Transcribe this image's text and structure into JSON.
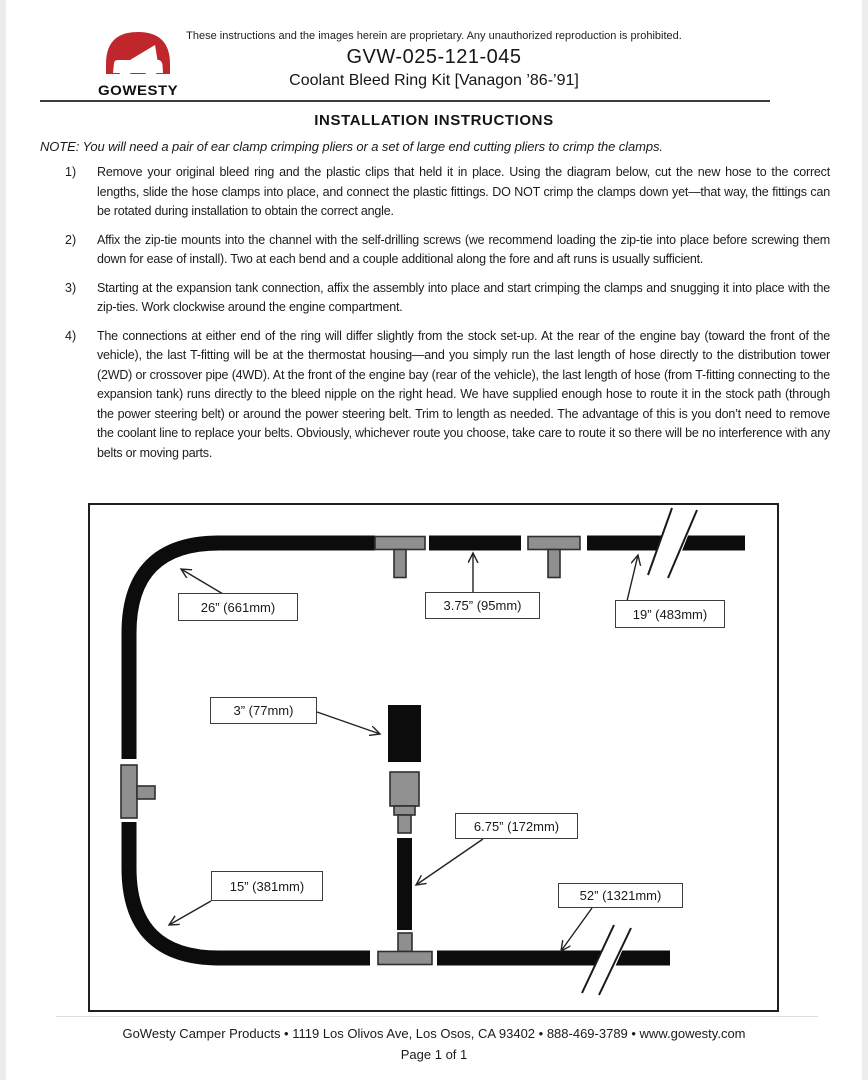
{
  "header": {
    "proprietary_notice": "These instructions and the images herein are proprietary. Any unauthorized reproduction is prohibited.",
    "part_number": "GVW-025-121-045",
    "product_title": "Coolant Bleed Ring Kit [Vanagon ’86-’91]",
    "logo_text": "GOWESTY",
    "logo_color": "#c0272d"
  },
  "title": "INSTALLATION INSTRUCTIONS",
  "note": "NOTE: You will need a pair of ear clamp crimping pliers or a set of large end cutting pliers to crimp the clamps.",
  "steps": [
    {
      "num": "1)",
      "text": "Remove your original bleed ring and the plastic clips that held it in place. Using the diagram below, cut the new hose to the correct lengths, slide the hose clamps into place, and connect the plastic fittings. DO NOT crimp the clamps down yet—that way, the fittings can be rotated during installation to obtain the correct angle."
    },
    {
      "num": "2)",
      "text": "Affix the zip-tie mounts into the channel with the self-drilling screws (we recommend loading the zip-tie into place before screwing them down for ease of install). Two at each bend and a couple additional along the fore and aft runs is usually sufficient."
    },
    {
      "num": "3)",
      "text": "Starting at the expansion tank connection, affix the assembly into place and start crimping the clamps and snugging it into place with the zip-ties. Work clockwise around the engine compartment."
    },
    {
      "num": "4)",
      "text": "The connections at either end of the ring will differ slightly from the stock set-up. At the rear of the engine bay (toward the front of the vehicle), the last T-fitting will be at the thermostat housing—and you simply run the last length of hose directly to the distribution tower (2WD) or crossover pipe (4WD). At the front of the engine bay (rear of the vehicle), the last length of hose (from T-fitting connecting to the expansion tank) runs directly to the bleed nipple on the right head. We have supplied enough hose to route it in the stock path (through the power steering belt) or around the power steering belt. Trim to length as needed. The advantage of this is you don’t need to remove the coolant line to replace your belts. Obviously, whichever route you choose, take care to route it so there will be no interference with any belts or moving parts."
    }
  ],
  "diagram": {
    "labels": [
      "26” (661mm)",
      "3.75” (95mm)",
      "19” (483mm)",
      "3” (77mm)",
      "6.75” (172mm)",
      "15” (381mm)",
      "52” (1321mm)"
    ]
  },
  "footer": {
    "line1": "GoWesty Camper Products • 1119 Los Olivos Ave, Los Osos, CA 93402 • 888-469-3789 • www.gowesty.com",
    "line2": "Page 1 of 1"
  }
}
